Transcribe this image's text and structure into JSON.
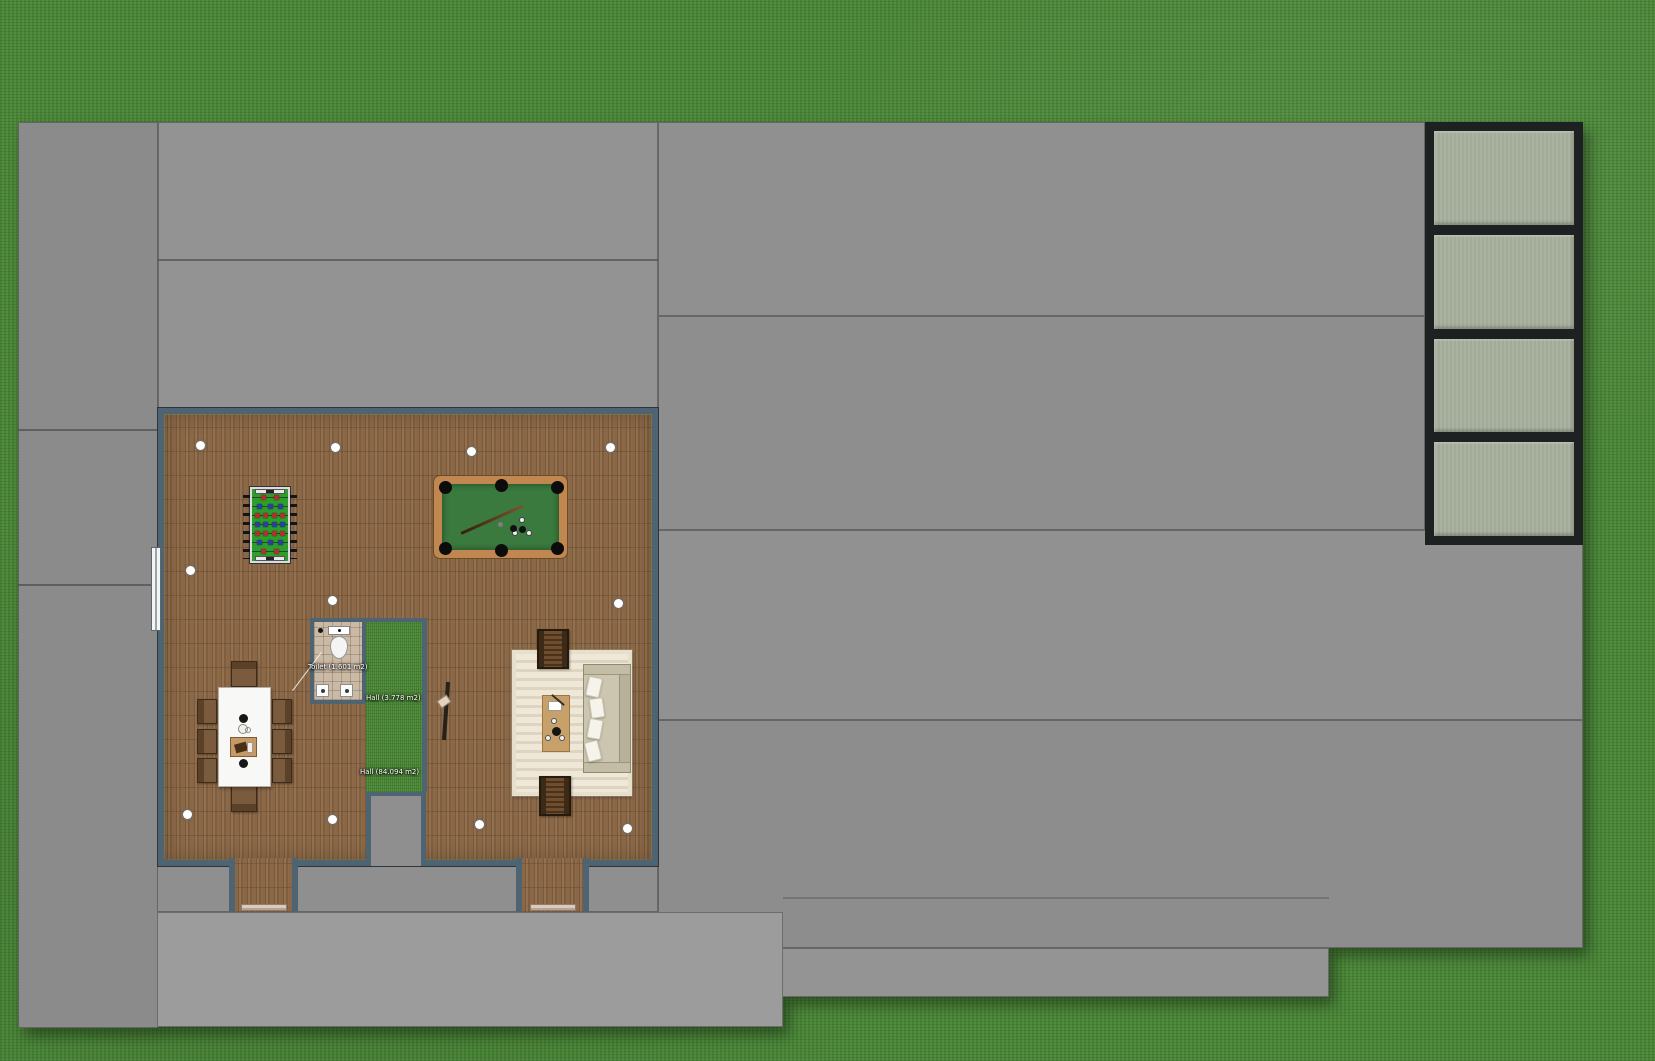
{
  "scene": {
    "description": "Top-down 2D floor plan: games room with wood floor on a gray patio surrounded by lawn"
  },
  "rooms": {
    "toilet": {
      "label": "Toilet (1.601 m2)"
    },
    "hall_small": {
      "label": "Hall (3.778 m2)"
    },
    "hall_large": {
      "label": "Hall (84.094 m2)"
    }
  },
  "colors": {
    "grass": "#4e8a3c",
    "concrete": "#8e8e8e",
    "concrete_light": "#9c9c9c",
    "wall": "#4e6472",
    "glass_pane": "#a9b29f",
    "glass_frame": "#1d2121",
    "pool_felt": "#3a7a3e",
    "pool_frame": "#c08850",
    "foosball_field": "#2d9e2d",
    "sofa": "#ccc6b0",
    "chair_wood": "#7b5b3e",
    "table_top": "#f8f8f6",
    "coffee_table": "#c8a06a"
  }
}
